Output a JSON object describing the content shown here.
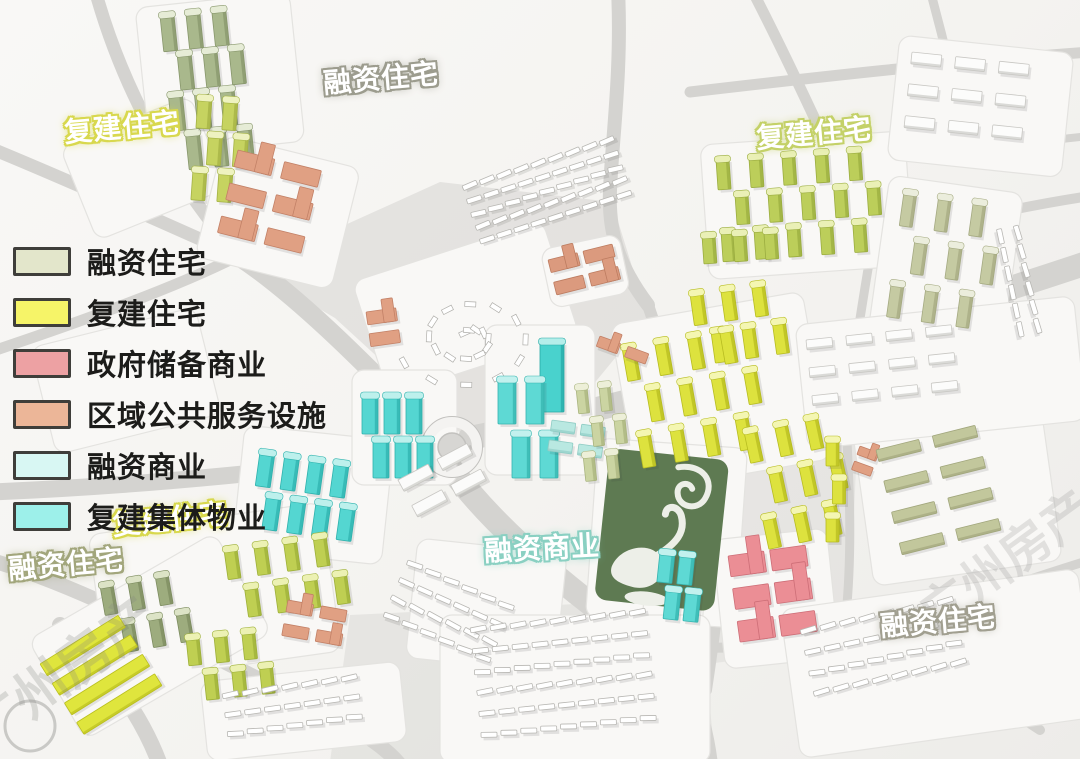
{
  "legend": {
    "items": [
      {
        "id": "rongzi-zhuzhai",
        "label": "融资住宅",
        "color": "#e3e6cb"
      },
      {
        "id": "fujian-zhuzhai",
        "label": "复建住宅",
        "color": "#f6f468"
      },
      {
        "id": "zhengfu-chubei-shangye",
        "label": "政府储备商业",
        "color": "#eda1a3"
      },
      {
        "id": "quyu-gonggong-fuwu",
        "label": "区域公共服务设施",
        "color": "#ecb698"
      },
      {
        "id": "rongzi-shangye",
        "label": "融资商业",
        "color": "#d8f7f3"
      },
      {
        "id": "fujian-jiti-wuye",
        "label": "复建集体物业",
        "color": "#9df0ea"
      }
    ]
  },
  "map_labels": [
    {
      "id": "label-financing-housing-north",
      "text": "融资住宅",
      "x": 323,
      "y": 57,
      "rot": -5,
      "glow": "#9c9c8e"
    },
    {
      "id": "label-rebuilt-housing-northwest",
      "text": "复建住宅",
      "x": 64,
      "y": 106,
      "rot": -5,
      "glow": "#d8d84e"
    },
    {
      "id": "label-rebuilt-housing-northeast",
      "text": "复建住宅",
      "x": 756,
      "y": 112,
      "rot": -5,
      "glow": "#c4d168"
    },
    {
      "id": "label-rebuilt-housing-southwest",
      "text": "复建住宅",
      "x": 112,
      "y": 498,
      "rot": -6,
      "glow": "#d8d84e"
    },
    {
      "id": "label-financing-housing-southwest",
      "text": "融资住宅",
      "x": 8,
      "y": 543,
      "rot": -5,
      "glow": "#a2a67c"
    },
    {
      "id": "label-financing-commercial-center",
      "text": "融资商业",
      "x": 484,
      "y": 527,
      "rot": -3,
      "glow": "#8ad0c2"
    },
    {
      "id": "label-financing-housing-southeast",
      "text": "融资住宅",
      "x": 880,
      "y": 600,
      "rot": -5,
      "glow": "#a19f90"
    }
  ],
  "watermarks": [
    {
      "id": "watermark-southwest",
      "text": "广州房产",
      "x": -14,
      "y": 752,
      "rot": -36,
      "size": 54,
      "opacity": 0.25
    },
    {
      "id": "watermark-east",
      "text": "广州房产",
      "x": 935,
      "y": 634,
      "rot": -36,
      "size": 50,
      "opacity": 0.2
    }
  ],
  "map": {
    "colors": {
      "background": "#f5f4f1",
      "road": "#d4d3d0",
      "park_green": "#5e7a52",
      "water_white": "#edefe8"
    },
    "pads": [
      {
        "x": 135,
        "y": 8,
        "w": 155,
        "h": 150,
        "rot": -6
      },
      {
        "x": 60,
        "y": 148,
        "w": 140,
        "h": 100,
        "rot": -22
      },
      {
        "x": 30,
        "y": 348,
        "w": 170,
        "h": 110,
        "rot": -14
      },
      {
        "x": 225,
        "y": 135,
        "w": 140,
        "h": 125,
        "rot": 14
      },
      {
        "x": 352,
        "y": 282,
        "w": 200,
        "h": 120,
        "rot": -18
      },
      {
        "x": 540,
        "y": 250,
        "w": 80,
        "h": 60,
        "rot": -12
      },
      {
        "x": 700,
        "y": 145,
        "w": 205,
        "h": 135,
        "rot": -4
      },
      {
        "x": 890,
        "y": 175,
        "w": 135,
        "h": 165,
        "rot": 8
      },
      {
        "x": 245,
        "y": 425,
        "w": 150,
        "h": 125,
        "rot": 6
      },
      {
        "x": 352,
        "y": 370,
        "w": 105,
        "h": 115,
        "rot": 0
      },
      {
        "x": 485,
        "y": 325,
        "w": 110,
        "h": 150,
        "rot": 0
      },
      {
        "x": 610,
        "y": 325,
        "w": 195,
        "h": 170,
        "rot": -10
      },
      {
        "x": 598,
        "y": 438,
        "w": 150,
        "h": 180,
        "rot": 4
      },
      {
        "x": 712,
        "y": 540,
        "w": 115,
        "h": 130,
        "rot": -6
      },
      {
        "x": 648,
        "y": 540,
        "w": 60,
        "h": 90,
        "rot": 4
      },
      {
        "x": 88,
        "y": 535,
        "w": 235,
        "h": 150,
        "rot": -8
      },
      {
        "x": 28,
        "y": 640,
        "w": 215,
        "h": 115,
        "rot": -30
      },
      {
        "x": 852,
        "y": 428,
        "w": 190,
        "h": 160,
        "rot": -8
      },
      {
        "x": 418,
        "y": 538,
        "w": 150,
        "h": 120,
        "rot": 6
      },
      {
        "x": 200,
        "y": 682,
        "w": 200,
        "h": 80,
        "rot": -6
      },
      {
        "x": 440,
        "y": 615,
        "w": 270,
        "h": 148,
        "rot": 0
      },
      {
        "x": 780,
        "y": 610,
        "w": 300,
        "h": 150,
        "rot": -8
      },
      {
        "x": 900,
        "y": 35,
        "w": 175,
        "h": 125,
        "rot": 6
      },
      {
        "x": 795,
        "y": 325,
        "w": 280,
        "h": 125,
        "rot": -6
      }
    ],
    "clusters": [
      {
        "name": "northwest-olive-towers",
        "category": "融资住宅",
        "type": "towers",
        "x": 160,
        "y": 16,
        "rot": -6,
        "rows": 4,
        "cols": 3,
        "bw": 14,
        "bh": 36,
        "gx": 12,
        "gy": 4,
        "color": "#a9b88c",
        "dark": "#88976c",
        "cap": "#e6ecd6"
      },
      {
        "name": "northwest-yellowgreen-towers",
        "category": "复建住宅",
        "type": "towers",
        "x": 198,
        "y": 98,
        "rot": 4,
        "rows": 3,
        "cols": 2,
        "bw": 14,
        "bh": 30,
        "gx": 12,
        "gy": 6,
        "color": "#c6d360",
        "dark": "#a4b244",
        "cap": "#eef2c0"
      },
      {
        "name": "northwest-salmon-blocks",
        "category": "区域公共服务设施",
        "type": "blocks",
        "x": 238,
        "y": 150,
        "rot": 14,
        "rows": 3,
        "cols": 2,
        "bw": 38,
        "bh": 17,
        "gx": 10,
        "gy": 17,
        "color": "#e0a083",
        "dark": "#c28066"
      },
      {
        "name": "west-salmon-blocks",
        "category": "区域公共服务设施",
        "type": "blocks",
        "x": 366,
        "y": 312,
        "rot": -8,
        "rows": 2,
        "cols": 1,
        "bw": 30,
        "bh": 13,
        "gx": 0,
        "gy": 9,
        "color": "#e0a083",
        "dark": "#c28066"
      },
      {
        "name": "north-salmon-courtyard",
        "category": "区域公共服务设施",
        "type": "blocks",
        "x": 548,
        "y": 260,
        "rot": -14,
        "rows": 2,
        "cols": 2,
        "bw": 30,
        "bh": 13,
        "gx": 6,
        "gy": 10,
        "color": "#db9a7e",
        "dark": "#bd7c60"
      },
      {
        "name": "north-village-rows",
        "type": "rows",
        "x": 462,
        "y": 186,
        "rot": -18,
        "rows": 5,
        "cols": 9,
        "bw": 15,
        "bh": 5,
        "gx": 3,
        "gy": 9,
        "color": "#ffffff",
        "dark": "#b8b7b3"
      },
      {
        "name": "north-village-spiral",
        "type": "spiral",
        "x": 468,
        "y": 338,
        "turns": 22,
        "color": "#ffffff",
        "dark": "#b0afab"
      },
      {
        "name": "northeast-yellowgreen-towers-a",
        "category": "复建住宅",
        "type": "towers",
        "x": 716,
        "y": 160,
        "rot": -4,
        "rows": 3,
        "cols": 5,
        "bw": 13,
        "bh": 30,
        "gx": 20,
        "gy": 6,
        "color": "#bcce5a",
        "dark": "#9bad40",
        "cap": "#eaf0b6"
      },
      {
        "name": "northeast-yellowgreen-towers-b",
        "category": "复建住宅",
        "type": "towers",
        "x": 702,
        "y": 236,
        "rot": -4,
        "rows": 1,
        "cols": 3,
        "bw": 13,
        "bh": 28,
        "gx": 18,
        "gy": 0,
        "color": "#bcce5a",
        "dark": "#9bad40",
        "cap": "#eaf0b6"
      },
      {
        "name": "east-paleolive-towers",
        "category": "融资住宅",
        "type": "towers",
        "x": 904,
        "y": 192,
        "rot": 8,
        "rows": 3,
        "cols": 3,
        "bw": 13,
        "bh": 34,
        "gx": 22,
        "gy": 12,
        "color": "#c5caa2",
        "dark": "#a5aa82",
        "cap": "#ebeddc"
      },
      {
        "name": "center-cyan-towers-west",
        "category": "复建集体物业",
        "type": "towers",
        "x": 362,
        "y": 396,
        "rot": 0,
        "rows": 2,
        "cols": 3,
        "bw": 16,
        "bh": 38,
        "gx": 6,
        "gy": 6,
        "color": "#54d6d1",
        "dark": "#2fb2ad",
        "cap": "#bdf0ec"
      },
      {
        "name": "center-cyan-towers-southwest",
        "category": "复建集体物业",
        "type": "towers",
        "x": 260,
        "y": 452,
        "rot": 8,
        "rows": 2,
        "cols": 4,
        "bw": 15,
        "bh": 34,
        "gx": 10,
        "gy": 8,
        "color": "#54d6d1",
        "dark": "#2fb2ad",
        "cap": "#bdf0ec"
      },
      {
        "name": "center-cyan-tower-tall",
        "category": "复建集体物业",
        "type": "towers",
        "x": 540,
        "y": 342,
        "rot": 0,
        "rows": 1,
        "cols": 1,
        "bw": 24,
        "bh": 70,
        "gx": 0,
        "gy": 0,
        "color": "#49d2cd",
        "dark": "#27aaa5",
        "cap": "#b4eeea"
      },
      {
        "name": "center-cyan-towers-east",
        "category": "复建集体物业",
        "type": "towers",
        "x": 498,
        "y": 380,
        "rot": 0,
        "rows": 2,
        "cols": 2,
        "bw": 18,
        "bh": 44,
        "gx": 10,
        "gy": 10,
        "color": "#5ed9d4",
        "dark": "#36b4af",
        "cap": "#c2f1ee"
      },
      {
        "name": "center-palecyan-blocks",
        "category": "融资商业",
        "type": "slabs",
        "x": 552,
        "y": 420,
        "rot": 8,
        "rows": 2,
        "cols": 2,
        "bw": 24,
        "bh": 11,
        "gx": 6,
        "gy": 9,
        "color": "#b9e8e1",
        "dark": "#8fccc4"
      },
      {
        "name": "center-palegreen-towers",
        "category": "融资住宅",
        "type": "towers",
        "x": 576,
        "y": 388,
        "rot": -6,
        "rows": 3,
        "cols": 2,
        "bw": 11,
        "bh": 26,
        "gx": 12,
        "gy": 8,
        "color": "#cbd4a2",
        "dark": "#a9b47e",
        "cap": "#edefd8"
      },
      {
        "name": "center-yellow-towers-north",
        "category": "复建住宅",
        "type": "towers",
        "x": 690,
        "y": 294,
        "rot": -8,
        "rows": 2,
        "cols": 3,
        "bw": 13,
        "bh": 32,
        "gx": 18,
        "gy": 8,
        "color": "#dde23e",
        "dark": "#b7bc20",
        "cap": "#f4f6b2"
      },
      {
        "name": "center-yellow-towers-main",
        "category": "复建住宅",
        "type": "towers",
        "x": 622,
        "y": 348,
        "rot": -10,
        "rows": 3,
        "cols": 4,
        "bw": 13,
        "bh": 34,
        "gx": 20,
        "gy": 10,
        "color": "#dde23e",
        "dark": "#b7bc20",
        "cap": "#f4f6b2"
      },
      {
        "name": "park-east-yellow-towers",
        "category": "复建住宅",
        "type": "towers",
        "x": 744,
        "y": 432,
        "rot": -12,
        "rows": 3,
        "cols": 3,
        "bw": 13,
        "bh": 32,
        "gx": 18,
        "gy": 12,
        "color": "#dde23e",
        "dark": "#b7bc20",
        "cap": "#f4f6b2"
      },
      {
        "name": "south-cyan-towers",
        "category": "复建集体物业",
        "type": "towers",
        "x": 660,
        "y": 552,
        "rot": 6,
        "rows": 2,
        "cols": 2,
        "bw": 15,
        "bh": 30,
        "gx": 5,
        "gy": 6,
        "color": "#5ed9d4",
        "dark": "#36b4af",
        "cap": "#c2f1ee"
      },
      {
        "name": "south-pink-blocks",
        "category": "政府储备商业",
        "type": "blocks",
        "x": 728,
        "y": 556,
        "rot": -8,
        "rows": 3,
        "cols": 2,
        "bw": 36,
        "bh": 21,
        "gx": 6,
        "gy": 12,
        "color": "#eb8e95",
        "dark": "#cd6e77"
      },
      {
        "name": "southwest-yellowgreen-towers-a",
        "category": "复建住宅",
        "type": "towers",
        "x": 224,
        "y": 550,
        "rot": -8,
        "rows": 2,
        "cols": 4,
        "bw": 13,
        "bh": 30,
        "gx": 17,
        "gy": 10,
        "color": "#bfcf52",
        "dark": "#9eb039",
        "cap": "#ecf1b3"
      },
      {
        "name": "southwest-olive-towers",
        "category": "融资住宅",
        "type": "towers",
        "x": 100,
        "y": 586,
        "rot": -10,
        "rows": 2,
        "cols": 3,
        "bw": 13,
        "bh": 30,
        "gx": 15,
        "gy": 10,
        "color": "#9dac7e",
        "dark": "#7d8c60",
        "cap": "#dce3c6"
      },
      {
        "name": "southwest-yellowgreen-towers-b",
        "category": "复建住宅",
        "type": "towers",
        "x": 186,
        "y": 638,
        "rot": -6,
        "rows": 2,
        "cols": 3,
        "bw": 13,
        "bh": 28,
        "gx": 15,
        "gy": 8,
        "color": "#bfcf52",
        "dark": "#9eb039",
        "cap": "#ecf1b3"
      },
      {
        "name": "southwest-corner-yellow-slabs",
        "category": "复建住宅",
        "type": "slabs",
        "x": 40,
        "y": 664,
        "rot": -32,
        "rows": 4,
        "cols": 1,
        "bw": 92,
        "bh": 14,
        "gx": 0,
        "gy": 9,
        "color": "#dfe53d",
        "dark": "#babf1e"
      },
      {
        "name": "southwest-salmon-blocks",
        "category": "区域公共服务设施",
        "type": "blocks",
        "x": 288,
        "y": 600,
        "rot": 10,
        "rows": 2,
        "cols": 2,
        "bw": 26,
        "bh": 12,
        "gx": 8,
        "gy": 12,
        "color": "#e0a083",
        "dark": "#c28066"
      },
      {
        "name": "east-salmon-small",
        "category": "区域公共服务设施",
        "type": "blocks",
        "x": 860,
        "y": 446,
        "rot": 20,
        "rows": 2,
        "cols": 1,
        "bw": 20,
        "bh": 9,
        "gx": 0,
        "gy": 7,
        "color": "#e0a083",
        "dark": "#c28066"
      },
      {
        "name": "east-paleolive-slabs",
        "category": "融资住宅",
        "type": "slabs",
        "x": 876,
        "y": 450,
        "rot": -14,
        "rows": 4,
        "cols": 2,
        "bw": 44,
        "bh": 12,
        "gx": 14,
        "gy": 20,
        "color": "#c2c79c",
        "dark": "#a1a67c"
      },
      {
        "name": "east-yellow-towers-small",
        "category": "复建住宅",
        "type": "towers",
        "x": 826,
        "y": 440,
        "rot": 0,
        "rows": 3,
        "cols": 1,
        "bw": 13,
        "bh": 26,
        "gx": 0,
        "gy": 12,
        "color": "#dde23e",
        "dark": "#b7bc20",
        "cap": "#f4f6b2"
      },
      {
        "name": "center-salmon-tiny",
        "category": "区域公共服务设施",
        "type": "blocks",
        "x": 600,
        "y": 336,
        "rot": 20,
        "rows": 1,
        "cols": 2,
        "bw": 22,
        "bh": 11,
        "gx": 8,
        "gy": 0,
        "color": "#e0a083",
        "dark": "#c28066"
      },
      {
        "name": "south-village-arcs",
        "type": "rows",
        "x": 408,
        "y": 560,
        "rot": 24,
        "rows": 4,
        "cols": 6,
        "bw": 16,
        "bh": 5,
        "gx": 4,
        "gy": 14,
        "color": "#ffffff",
        "dark": "#b8b7b3"
      },
      {
        "name": "south-village-grid",
        "type": "rows",
        "x": 470,
        "y": 628,
        "rot": -6,
        "rows": 6,
        "cols": 9,
        "bw": 16,
        "bh": 5,
        "gx": 4,
        "gy": 16,
        "color": "#ffffff",
        "dark": "#b8b7b3"
      },
      {
        "name": "southwest-village-rows",
        "type": "rows",
        "x": 222,
        "y": 694,
        "rot": -8,
        "rows": 3,
        "cols": 7,
        "bw": 16,
        "bh": 5,
        "gx": 4,
        "gy": 14,
        "color": "#ffffff",
        "dark": "#b8b7b3"
      },
      {
        "name": "southeast-village-rows",
        "type": "rows",
        "x": 800,
        "y": 630,
        "rot": -12,
        "rows": 4,
        "cols": 8,
        "bw": 16,
        "bh": 5,
        "gx": 4,
        "gy": 16,
        "color": "#ffffff",
        "dark": "#b8b7b3"
      },
      {
        "name": "east-white-slabs",
        "type": "slabs",
        "x": 806,
        "y": 340,
        "rot": -6,
        "rows": 3,
        "cols": 4,
        "bw": 26,
        "bh": 10,
        "gx": 14,
        "gy": 18,
        "color": "#fcfcfb",
        "dark": "#c8c7c3"
      },
      {
        "name": "northeast-white-slabs",
        "type": "slabs",
        "x": 912,
        "y": 52,
        "rot": 6,
        "rows": 3,
        "cols": 3,
        "bw": 30,
        "bh": 12,
        "gx": 14,
        "gy": 20,
        "color": "#fcfcfb",
        "dark": "#c8c7c3"
      },
      {
        "name": "east-edge-white-rows",
        "type": "rows",
        "x": 1018,
        "y": 225,
        "rot": 78,
        "rows": 2,
        "cols": 6,
        "bw": 15,
        "bh": 5,
        "gx": 4,
        "gy": 12,
        "color": "#ffffff",
        "dark": "#b8b7b3"
      },
      {
        "name": "center-white-slabs",
        "type": "slabs",
        "x": 398,
        "y": 480,
        "rot": -28,
        "rows": 2,
        "cols": 2,
        "bw": 34,
        "bh": 13,
        "gx": 10,
        "gy": 16,
        "color": "#fbfbfa",
        "dark": "#c8c7c3"
      }
    ]
  }
}
